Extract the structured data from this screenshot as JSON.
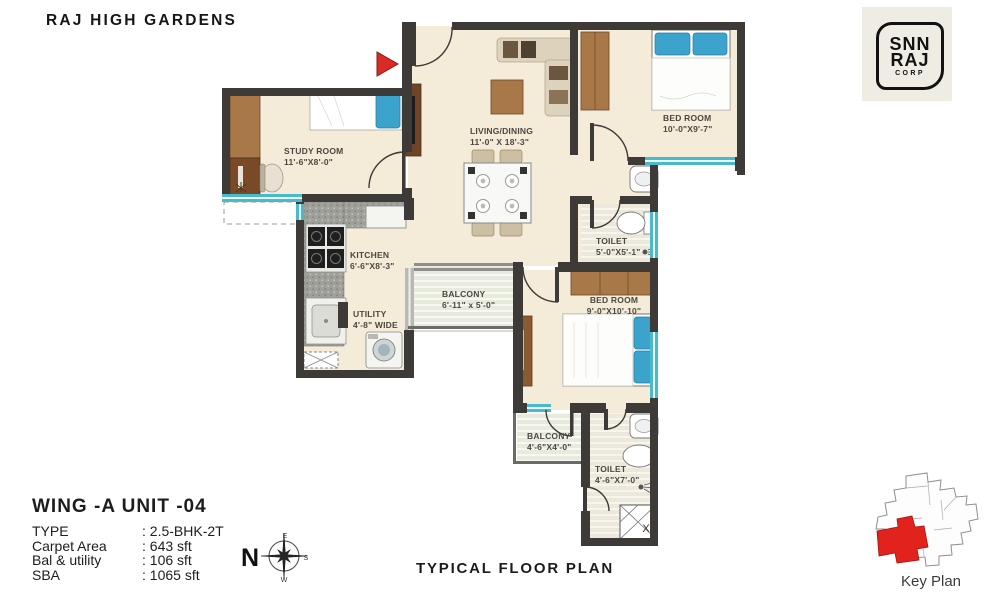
{
  "project_title": "RAJ HIGH GARDENS",
  "logo": {
    "line1": "SNN",
    "line2": "RAJ",
    "line3": "CORP"
  },
  "plan": {
    "rooms": [
      {
        "name": "STUDY ROOM",
        "dims": "11'-6\"X8'-0\""
      },
      {
        "name": "LIVING/DINING",
        "dims": "11'-0\" X 18'-3\""
      },
      {
        "name": "BED ROOM",
        "dims": "10'-0\"X9'-7\""
      },
      {
        "name": "KITCHEN",
        "dims": "6'-6\"X8'-3\""
      },
      {
        "name": "UTILITY",
        "dims": "4'-8\" WIDE"
      },
      {
        "name": "BALCONY",
        "dims": "6'-11\" x 5'-0\""
      },
      {
        "name": "TOILET",
        "dims": "5'-0\"X5'-1\""
      },
      {
        "name": "BED ROOM",
        "dims": "9'-0\"X10'-10\""
      },
      {
        "name": "BALCONY",
        "dims": "4'-6\"X4'-0\""
      },
      {
        "name": "TOILET",
        "dims": "4'-6\"X7'-0\""
      }
    ],
    "shaft_label": "X"
  },
  "info": {
    "unit_title": "WING -A  UNIT -04",
    "rows": [
      {
        "label": "TYPE",
        "value": ": 2.5-BHK-2T"
      },
      {
        "label": "Carpet Area",
        "value": ": 643 sft"
      },
      {
        "label": "Bal & utility",
        "value": ": 106 sft"
      },
      {
        "label": "SBA",
        "value": ": 1065 sft"
      }
    ]
  },
  "compass": {
    "n": "N",
    "e": "E",
    "s": "S",
    "w": "W"
  },
  "footer_title": "TYPICAL FLOOR PLAN",
  "key_plan": {
    "label": "Key Plan"
  },
  "colors": {
    "wall": "#3e3a37",
    "floor": "#f4ebd9",
    "window_teal": "#49b9cc",
    "accent_red": "#d92b26",
    "furniture_brown": "#a97848",
    "bed_blue": "#3ba3cc"
  }
}
